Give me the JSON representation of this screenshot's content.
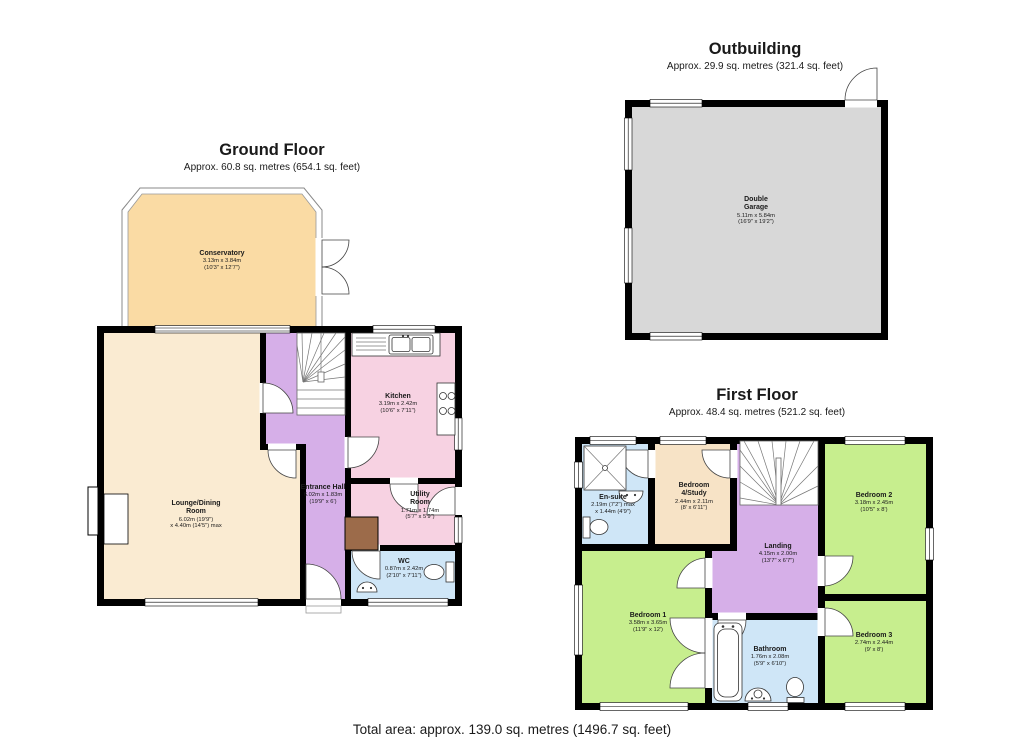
{
  "sections": {
    "ground_floor": {
      "title": "Ground Floor",
      "subtitle": "Approx. 60.8 sq. metres (654.1 sq. feet)"
    },
    "outbuilding": {
      "title": "Outbuilding",
      "subtitle": "Approx. 29.9 sq. metres (321.4 sq. feet)"
    },
    "first_floor": {
      "title": "First Floor",
      "subtitle": "Approx. 48.4 sq. metres (521.2 sq. feet)"
    }
  },
  "footer": {
    "total_area": "Total area: approx. 139.0 sq. metres (1496.7 sq. feet)"
  },
  "rooms": {
    "conservatory": {
      "name": "Conservatory",
      "dims1": "3.13m x 3.84m",
      "dims2": "(10'3\" x 12'7\")"
    },
    "lounge_dining": {
      "name": "Lounge/Dining Room",
      "dims1": "6.02m (19'9\")",
      "dims2": "x 4.40m (14'5\") max"
    },
    "entrance_hall": {
      "name": "Entrance Hall",
      "dims1": "6.02m x 1.83m",
      "dims2": "(19'9\" x 6')"
    },
    "kitchen": {
      "name": "Kitchen",
      "dims1": "3.19m x 2.42m",
      "dims2": "(10'6\" x 7'11\")"
    },
    "utility": {
      "name": "Utility Room",
      "dims1": "1.71m x 1.74m",
      "dims2": "(5'7\" x 5'9\")"
    },
    "wc": {
      "name": "WC",
      "dims1": "0.87m x 2.42m",
      "dims2": "(2'10\" x 7'11\")"
    },
    "garage": {
      "name": "Double Garage",
      "dims1": "5.11m x 5.84m",
      "dims2": "(16'9\" x 19'2\")"
    },
    "ensuite": {
      "name": "En-suite",
      "dims1": "2.19m (7'2\") max",
      "dims2": "x 1.44m (4'9\")"
    },
    "bed4": {
      "name": "Bedroom 4/Study",
      "dims1": "2.44m x 2.11m",
      "dims2": "(8' x 6'11\")"
    },
    "landing": {
      "name": "Landing",
      "dims1": "4.15m x 2.00m",
      "dims2": "(13'7\" x 6'7\")"
    },
    "bed2": {
      "name": "Bedroom 2",
      "dims1": "3.18m x 2.45m",
      "dims2": "(10'5\" x 8')"
    },
    "bed1": {
      "name": "Bedroom 1",
      "dims1": "3.58m x 3.65m",
      "dims2": "(11'9\" x 12')"
    },
    "bathroom": {
      "name": "Bathroom",
      "dims1": "1.76m x 2.08m",
      "dims2": "(5'9\" x 6'10\")"
    },
    "bed3": {
      "name": "Bedroom 3",
      "dims1": "2.74m x 2.44m",
      "dims2": "(9' x 8')"
    }
  },
  "colors": {
    "wall": "#000000",
    "conservatory": "#FADBA4",
    "lounge": "#FAEBD2",
    "hall": "#D6AFE8",
    "kitchen": "#F7D2E2",
    "bath_blue": "#CFE6F7",
    "bedroom_green": "#C7EE8E",
    "garage_grey": "#D8D8D8",
    "cupboard_brown": "#9C6B4A",
    "bed4_cream": "#F7E3C6"
  }
}
